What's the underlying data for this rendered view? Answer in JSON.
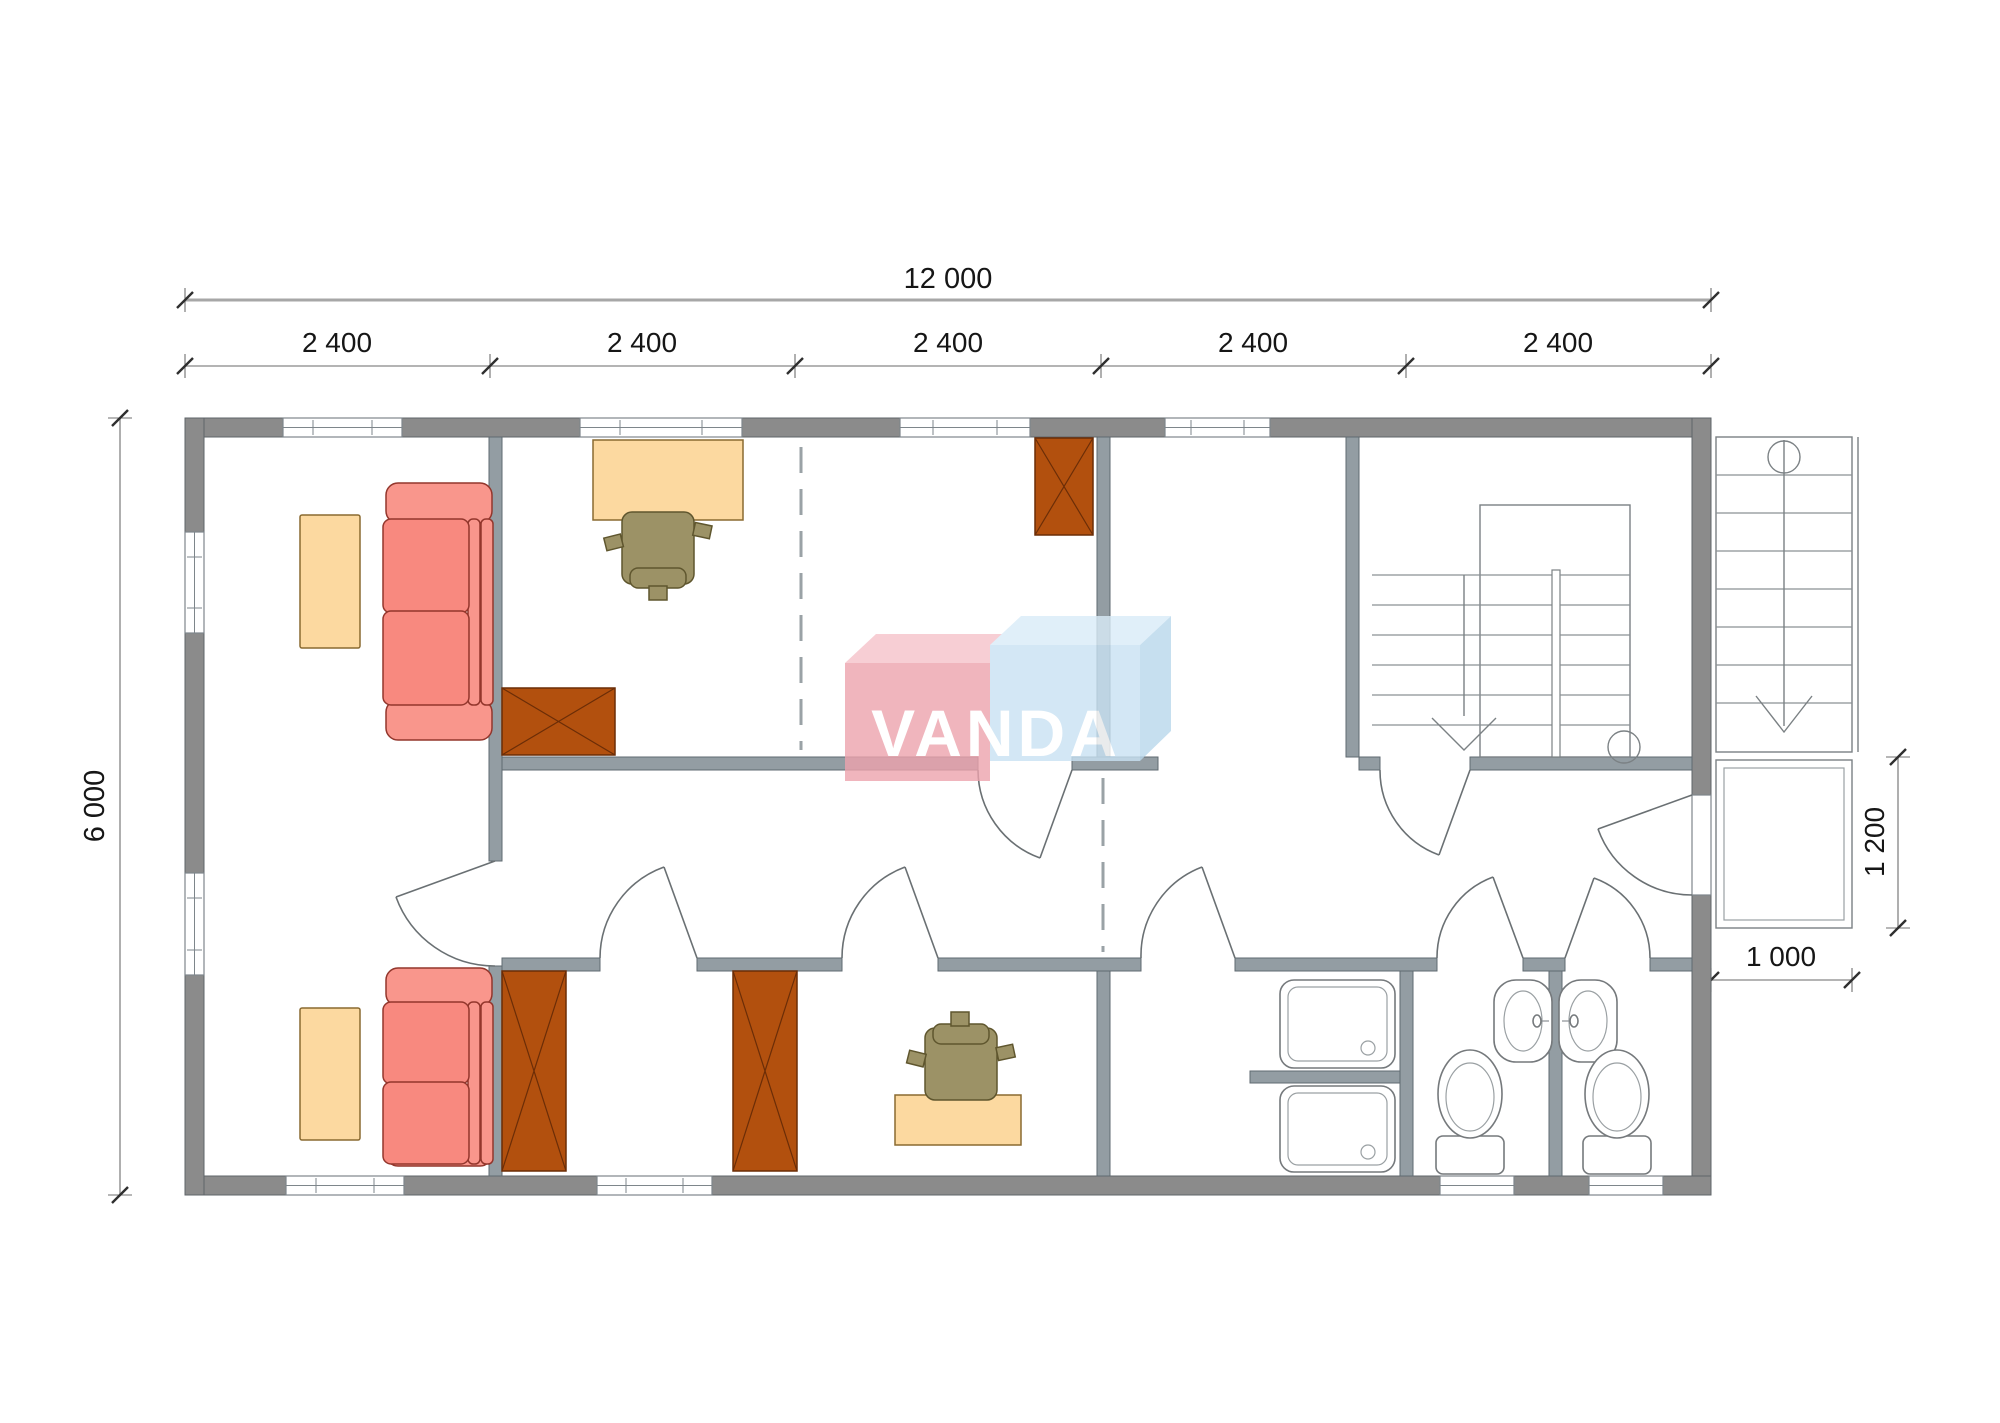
{
  "watermark": {
    "text": "VANDA"
  },
  "dimensions": {
    "total_width": "12 000",
    "bays": [
      "2 400",
      "2 400",
      "2 400",
      "2 400",
      "2 400"
    ],
    "height": "6 000",
    "porch_height": "1 200",
    "porch_width": "1 000"
  },
  "colors": {
    "wall_exterior": "#8b8b8b",
    "wall_interior": "#939da3",
    "sofa_seat": "#f8897f",
    "sofa_frame": "#f9968c",
    "table": "#fcd9a0",
    "wardrobe": "#b2500e",
    "chair": "#9c9266",
    "logo_pink": "#eda3ad",
    "logo_pink_top": "#f6c3ca",
    "logo_blue": "#c9e2f3",
    "logo_blue_top": "#d9ecf8",
    "logo_blue_side": "#b9d8ec"
  }
}
